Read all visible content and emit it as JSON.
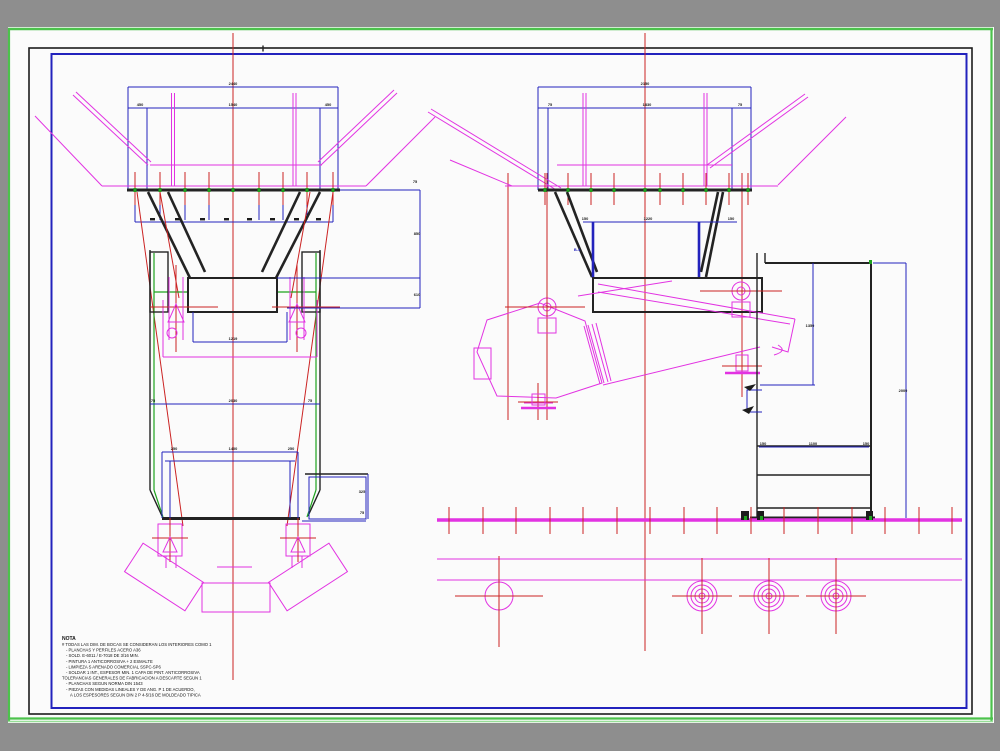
{
  "viewer": {
    "background_color": "#8e8e8e",
    "sheet_color": "#fbfbfb"
  },
  "palette": {
    "border_green": "#4cc24c",
    "border_green_light": "#96dd96",
    "frame_black": "#1c1c1c",
    "frame_blue": "#2323bd",
    "dimension_blue": "#2323bd",
    "centerline_red": "#cb2323",
    "detail_magenta": "#e233e2",
    "structure_black": "#232323",
    "accent_green": "#1ea21e"
  },
  "dims": {
    "d1": "2440",
    "d2": "450",
    "d3": "1540",
    "d4": "450",
    "d5": "75",
    "d6": "2030",
    "d7": "75",
    "d8": "250",
    "d9": "1400",
    "d10": "250",
    "d11": "850",
    "d12": "610",
    "d13": "325",
    "d14": "75",
    "d15": "1219",
    "d16": "75",
    "d17": "2150",
    "d18": "75",
    "d19": "1830",
    "d20": "75",
    "d21": "150",
    "d22": "1220",
    "d23": "150",
    "d24": "B-4",
    "d25": "1350",
    "d26": "2000",
    "d27": "150",
    "d28": "1100",
    "d29": "150"
  },
  "notes": {
    "title": "NOTA",
    "lines": [
      "# TODAS LAS DIM. DE BOCAS SE CONSIDERAN LOS INTERIORES COMO 1",
      "- PLANCHAS Y PERFILES ACERO A36",
      "- SOLD. E-6011 / E-7018 DE 3/16 MIN.",
      "- PINTURA 1 ANTICORROSIVA + 2 ESMALTE",
      "- LIMPIEZA S ARENADO COMERCIAL SSPC-SP6",
      "- SOLDAR 1 INT., ESPESOR MIN. 1 CAPA DE PINT. ANTICORROSIVA",
      "TOLERANCIAS GENERALES DE FABRICACION A DESCARTE SEGUN 1",
      "- PLANCHAS SEGUN NORMA DIN 1543",
      "- PIEZAS CON MEDIDAS LINEALES Y DE ANG. P 1 DE ACUERDO,",
      "  A LOS ESPESORES SEGUN DIN 2 P 4-5/16 DE MOLDEADO TIPICA"
    ]
  }
}
